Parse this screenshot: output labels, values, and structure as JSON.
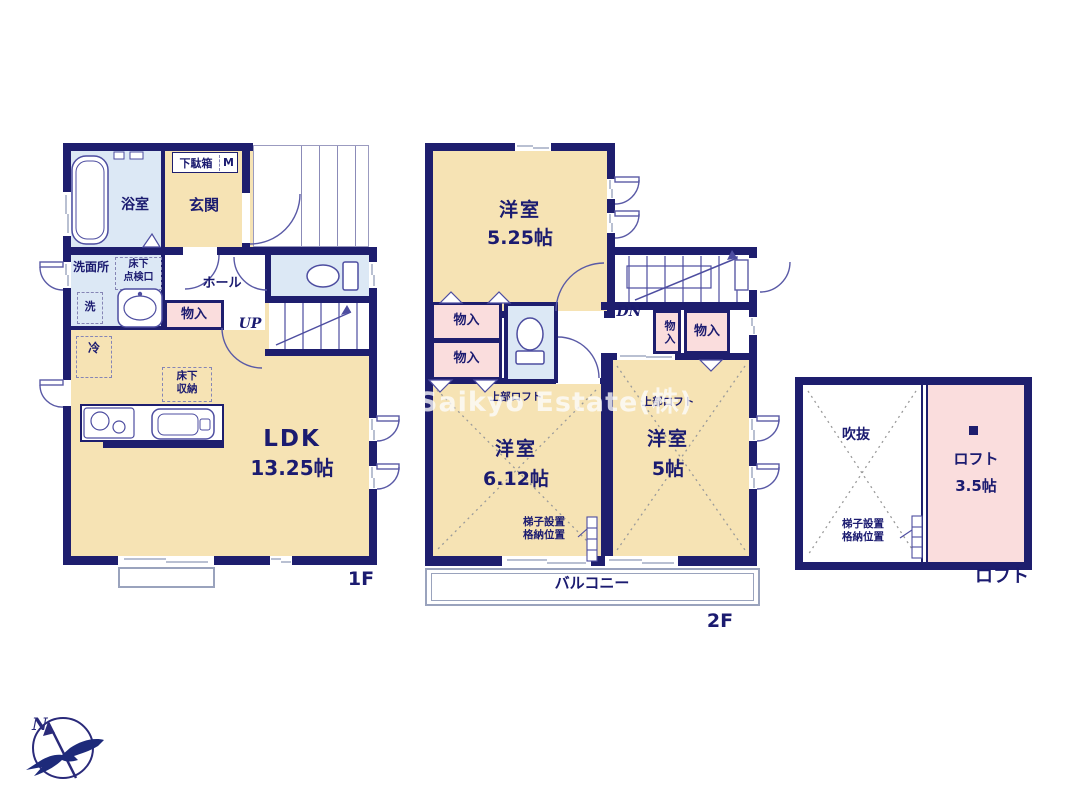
{
  "watermark": "Saikyo Estate(株)",
  "compass": {
    "north": "N"
  },
  "palette": {
    "wall": "#1e1e6e",
    "room_cream": "#f6e3b4",
    "wet_blue": "#dce8f5",
    "closet_pink": "#fadddd",
    "text_navy": "#1b1b70"
  },
  "shared": {
    "storage": "物入",
    "western_room": "洋室",
    "upper_loft": "上部ロフト",
    "ladder_line1": "梯子設置",
    "ladder_line2": "格納位置"
  },
  "floor1": {
    "floor_label": "1F",
    "bath": "浴室",
    "entrance": "玄関",
    "shoe_cabinet": "下駄箱",
    "shoe_cabinet_mark": "M",
    "washroom": "洗面所",
    "hatch_line1": "床下",
    "hatch_line2": "点検口",
    "washer": "洗",
    "hall": "ホール",
    "up": "UP",
    "fridge": "冷",
    "floor_storage_line1": "床下",
    "floor_storage_line2": "収納",
    "ldk": "LDK",
    "ldk_size": "13.25帖"
  },
  "floor2": {
    "floor_label": "2F",
    "room1_size": "5.25帖",
    "dn": "DN",
    "room2_size": "6.12帖",
    "room3_size": "5帖",
    "balcony": "バルコニー"
  },
  "loft": {
    "floor_label": "ロフト",
    "void": "吹抜",
    "room": "ロフト",
    "room_size": "3.5帖"
  }
}
